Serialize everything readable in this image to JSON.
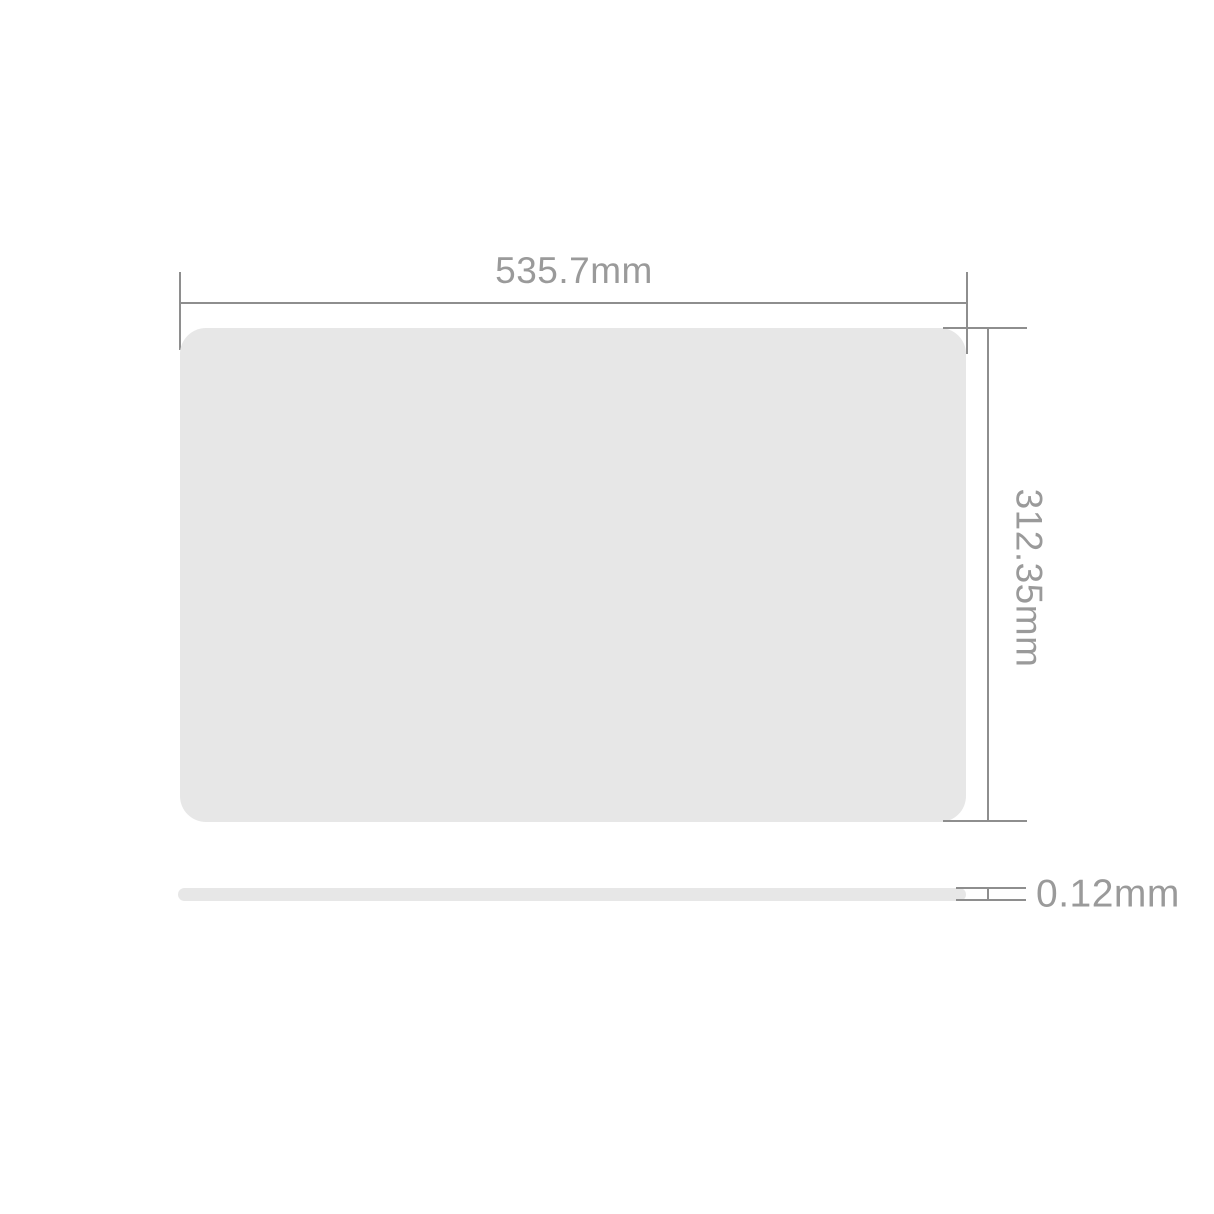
{
  "diagram": {
    "type": "product-dimension-diagram",
    "views": {
      "front": "rounded-rectangle-panel",
      "side": "thin-bar"
    },
    "dimensions": {
      "width_label": "535.7mm",
      "height_label": "312.35mm",
      "thickness_label": "0.12mm"
    },
    "colors": {
      "background": "#ffffff",
      "panel_fill": "#e7e7e7",
      "dimension_line": "#8e8e8e",
      "label_text": "#9a9a9a"
    }
  }
}
